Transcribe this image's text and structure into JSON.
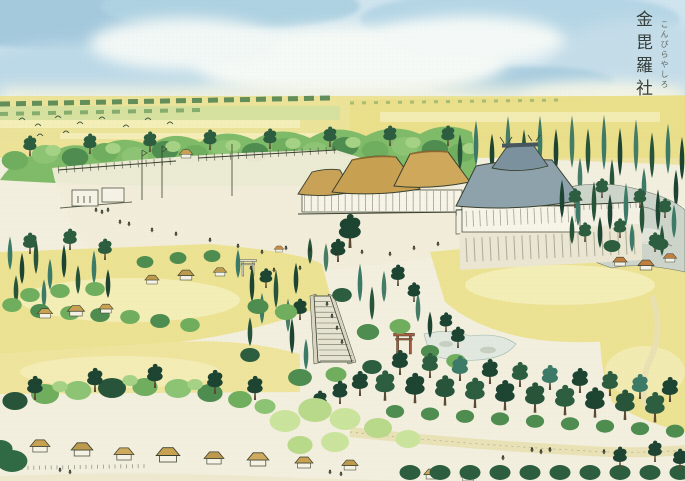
{
  "title": {
    "kanji": "金毘羅社",
    "furigana": "こんぴらやしろ"
  },
  "palette": {
    "paper": "#f3efdf",
    "sky_blue": "#cfe4ee",
    "sky_deep": "#a4c9dd",
    "cloud_white": "#f6faf6",
    "field_yellow": "#ece292",
    "field_pale": "#f6f0bf",
    "grass_light": "#a5d284",
    "tree_green": "#7fbb68",
    "tree_dark": "#27543a",
    "conifer_teal": "#3c7a68",
    "thatch_tan": "#c8a152",
    "thatch_dark": "#8a6a30",
    "roof_gray": "#8ea2ac",
    "roof_gray_dark": "#46555e",
    "stone_gray": "#cdd5ca",
    "path_tan": "#e9e0b4",
    "torii_red": "#a85c40",
    "ink": "#39402f"
  },
  "scene": {
    "elements": [
      "sky",
      "clouds",
      "distant-fields",
      "ridge-treeline",
      "bird-flock",
      "shrine-courtyard",
      "entrance-fences",
      "thatched-halls",
      "main-hall",
      "stone-torii",
      "stair-torii",
      "stone-stairway",
      "cypress-grove",
      "rocky-slope",
      "rice-fields",
      "pine-row",
      "road-with-travelers",
      "farm-village",
      "bamboo-brush"
    ]
  }
}
